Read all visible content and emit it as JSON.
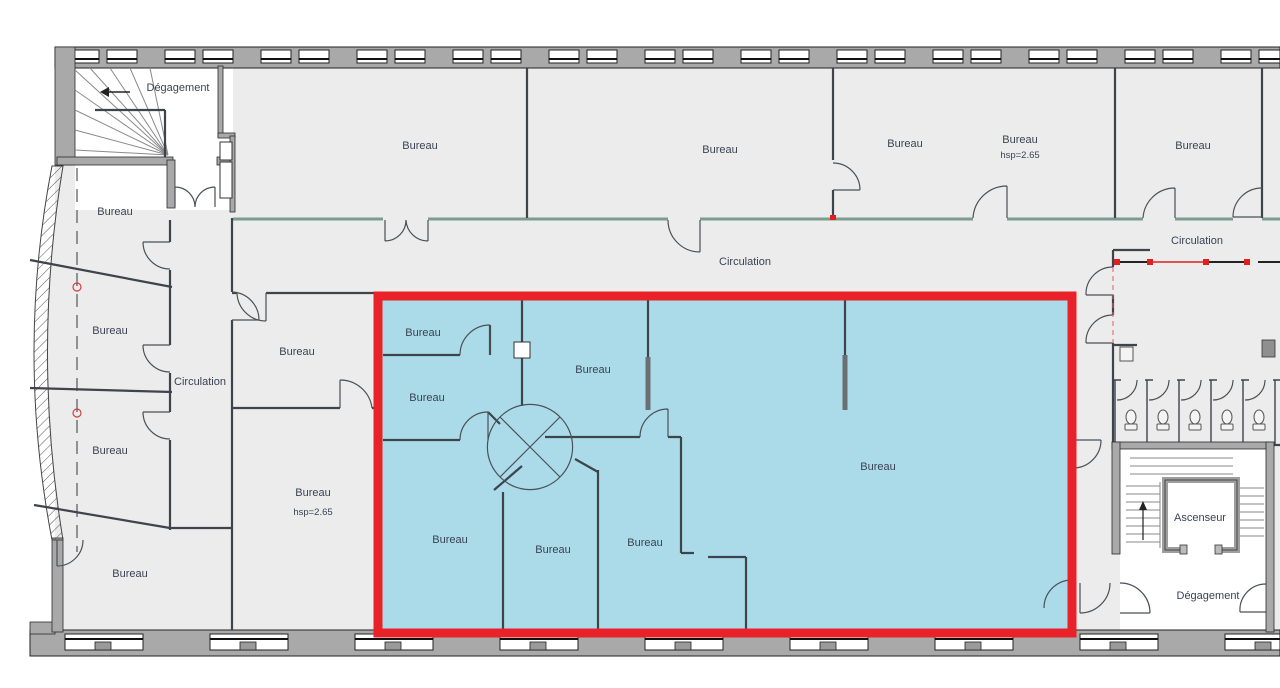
{
  "colors": {
    "highlight_fill": "#abdbe9",
    "highlight_border": "#e82228",
    "wall_gray": "#a9a9a9",
    "floor_gray": "#ececec",
    "demolition_red": "#e02020"
  },
  "annotations": [
    {
      "name": "room-label-degagement-nw",
      "text": "Dégagement",
      "x": 178,
      "y": 91
    },
    {
      "name": "room-label-bureau-top-1",
      "text": "Bureau",
      "x": 420,
      "y": 149
    },
    {
      "name": "room-label-bureau-top-2",
      "text": "Bureau",
      "x": 720,
      "y": 153
    },
    {
      "name": "room-label-bureau-top-3",
      "text": "Bureau",
      "x": 905,
      "y": 147
    },
    {
      "name": "room-label-bureau-top-4",
      "text": "Bureau",
      "x": 1020,
      "y": 143
    },
    {
      "name": "room-label-hsp-top",
      "text": "hsp=2.65",
      "x": 1020,
      "y": 158,
      "small": true
    },
    {
      "name": "room-label-bureau-top-5",
      "text": "Bureau",
      "x": 1193,
      "y": 149
    },
    {
      "name": "room-label-circulation-main",
      "text": "Circulation",
      "x": 745,
      "y": 265
    },
    {
      "name": "room-label-circulation-right",
      "text": "Circulation",
      "x": 1197,
      "y": 244
    },
    {
      "name": "room-label-bureau-west-1",
      "text": "Bureau",
      "x": 115,
      "y": 215
    },
    {
      "name": "room-label-bureau-west-2",
      "text": "Bureau",
      "x": 110,
      "y": 334
    },
    {
      "name": "room-label-circulation-west",
      "text": "Circulation",
      "x": 200,
      "y": 385
    },
    {
      "name": "room-label-bureau-mid-1",
      "text": "Bureau",
      "x": 297,
      "y": 355
    },
    {
      "name": "room-label-bureau-west-3",
      "text": "Bureau",
      "x": 110,
      "y": 454
    },
    {
      "name": "room-label-bureau-mid-2",
      "text": "Bureau",
      "x": 313,
      "y": 496
    },
    {
      "name": "room-label-hsp-mid",
      "text": "hsp=2.65",
      "x": 313,
      "y": 515,
      "small": true
    },
    {
      "name": "room-label-bureau-west-4",
      "text": "Bureau",
      "x": 130,
      "y": 577
    },
    {
      "name": "room-label-bureau-zone-1",
      "text": "Bureau",
      "x": 423,
      "y": 336
    },
    {
      "name": "room-label-bureau-zone-2",
      "text": "Bureau",
      "x": 593,
      "y": 373
    },
    {
      "name": "room-label-bureau-zone-3",
      "text": "Bureau",
      "x": 427,
      "y": 401
    },
    {
      "name": "room-label-bureau-zone-4",
      "text": "Bureau",
      "x": 878,
      "y": 470
    },
    {
      "name": "room-label-bureau-zone-5",
      "text": "Bureau",
      "x": 450,
      "y": 543
    },
    {
      "name": "room-label-bureau-zone-6",
      "text": "Bureau",
      "x": 553,
      "y": 553
    },
    {
      "name": "room-label-bureau-zone-7",
      "text": "Bureau",
      "x": 645,
      "y": 546
    },
    {
      "name": "room-label-ascenseur",
      "text": "Ascenseur",
      "x": 1200,
      "y": 521
    },
    {
      "name": "room-label-degagement-se",
      "text": "Dégagement",
      "x": 1208,
      "y": 599
    }
  ]
}
